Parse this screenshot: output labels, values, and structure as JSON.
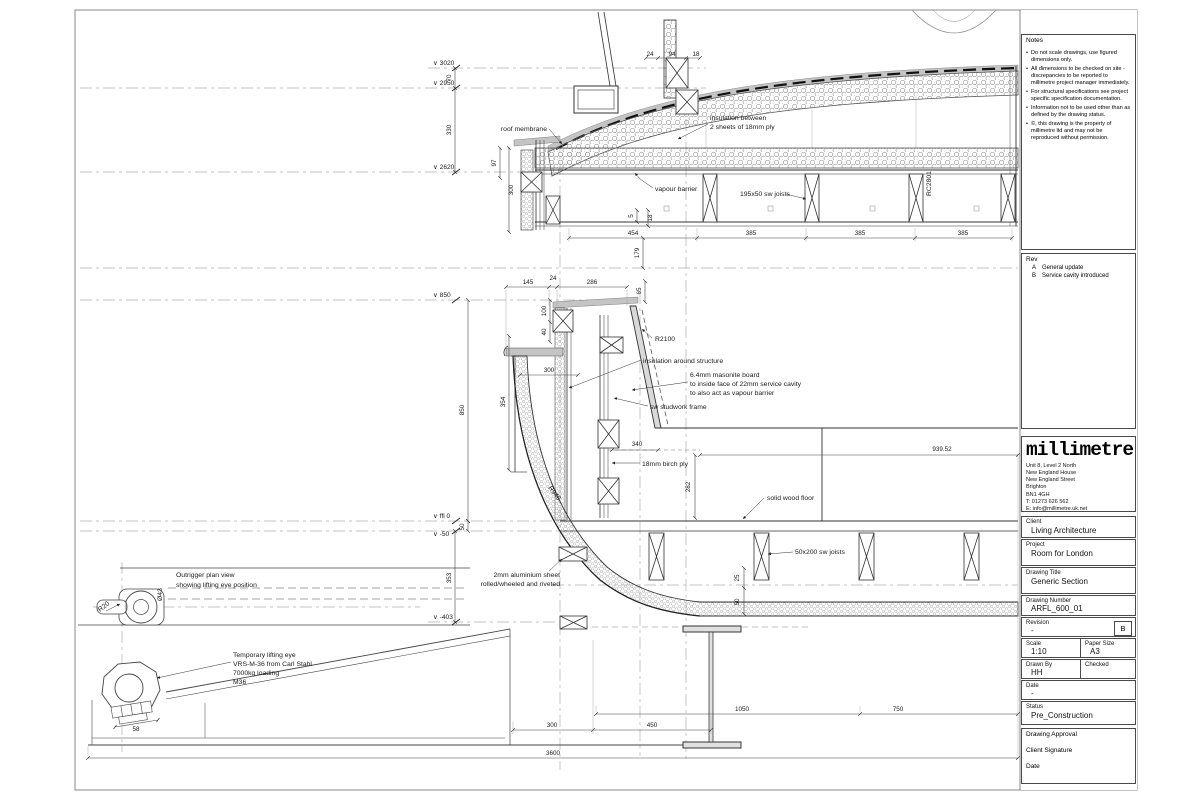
{
  "title_block": {
    "notes": {
      "heading": "Notes",
      "items": [
        "Do not scale drawings, use figured dimensions only.",
        "All dimensions to be checked on site - discrepancies to be reported to millimetre project manager immediately.",
        "For structural specifications see project specific specification documentation.",
        "Information not to be used other than as defined by the drawing status.",
        "©, this drawing is the property of millimetre ltd and may not be reproduced without permission."
      ]
    },
    "rev": {
      "heading": "Rev",
      "rows": [
        {
          "id": "A",
          "desc": "General update"
        },
        {
          "id": "B",
          "desc": "Service cavity introduced"
        }
      ]
    },
    "logo": {
      "name": "millimetre",
      "address_lines": [
        "Unit 8, Level 2 North",
        "New England House",
        "New England Street",
        "Brighton",
        "BN1 4GH",
        "T: 01273 626 562",
        "E: info@millimetre.uk.net"
      ]
    },
    "client": {
      "label": "Client",
      "value": "Living Architecture"
    },
    "project": {
      "label": "Project",
      "value": "Room for London"
    },
    "drawing_title": {
      "label": "Drawing Title",
      "value": "Generic Section"
    },
    "drawing_number": {
      "label": "Drawing Number",
      "value": "ARFL_600_01"
    },
    "revision": {
      "label": "Revision",
      "value": "-",
      "current": "B"
    },
    "scale": {
      "label": "Scale",
      "value": "1:10"
    },
    "paper_size": {
      "label": "Paper Size",
      "value": "A3"
    },
    "drawn_by": {
      "label": "Drawn By",
      "value": "HH"
    },
    "checked": {
      "label": "Checked",
      "value": ""
    },
    "date": {
      "label": "Date",
      "value": "-"
    },
    "status": {
      "label": "Status",
      "value": "Pre_Construction"
    },
    "approval": {
      "label": "Drawing Approval",
      "signature_label": "Client Signature",
      "date_label": "Date"
    }
  },
  "levels": [
    "∨ 3020",
    "∨ 2950",
    "∨ 2620",
    "∨ 850",
    "∨ ffl 0",
    "∨ -50",
    "∨ -403"
  ],
  "annotations": {
    "roof_membrane": "roof membrane",
    "insulation_between_1": "insulation between",
    "insulation_between_2": "2 sheets of 18mm ply",
    "vapour_barrier": "vapour barrier",
    "joists_195": "195x50 sw joists",
    "radius_r2100": "R2100",
    "insulation_structure": "insulation around structure",
    "masonite_1": "6.4mm masonite board",
    "masonite_2": "to inside face of 22mm service cavity",
    "masonite_3": "to also act as vapour barrier",
    "studwork": "sw studwork frame",
    "birch_ply": "18mm birch ply",
    "wood_floor": "solid wood floor",
    "joists_50x200": "50x200 sw joists",
    "alu_1": "2mm aluminium sheet",
    "alu_2": "rolled/wheeled and riveted",
    "outrigger_1": "Outrigger plan view",
    "outrigger_2": "showing lifting eye position",
    "lifting_1": "Temporary lifting eye",
    "lifting_2": "VRS-M-36 from Carl Stahl",
    "lifting_3": "7000kg loading",
    "lifting_4": "M36",
    "radius_r940": "R940",
    "radius_r20": "R20",
    "dia_43": "Ø43",
    "ref_rc2801": "RC2801"
  },
  "dimensions": {
    "d70": "70",
    "d330": "330",
    "d97": "97",
    "d300roof": "300",
    "d24top": "24",
    "d94": "94",
    "d18top": "18",
    "d454": "454",
    "d385a": "385",
    "d385b": "385",
    "d385c": "385",
    "d5": "5",
    "d18b": "18",
    "d179": "179",
    "d145": "145",
    "d24b": "24",
    "d286": "286",
    "d65": "65",
    "d100": "100",
    "d40": "40",
    "d850": "850",
    "d354": "354",
    "d300wall": "300",
    "d340": "340",
    "d282": "282",
    "d939": "939.52",
    "d50lvl": "50",
    "d353": "353",
    "d25": "25",
    "d50deck": "50",
    "d300b": "300",
    "d450": "450",
    "d1050": "1050",
    "d750": "750",
    "d3600": "3600",
    "d58": "58"
  }
}
